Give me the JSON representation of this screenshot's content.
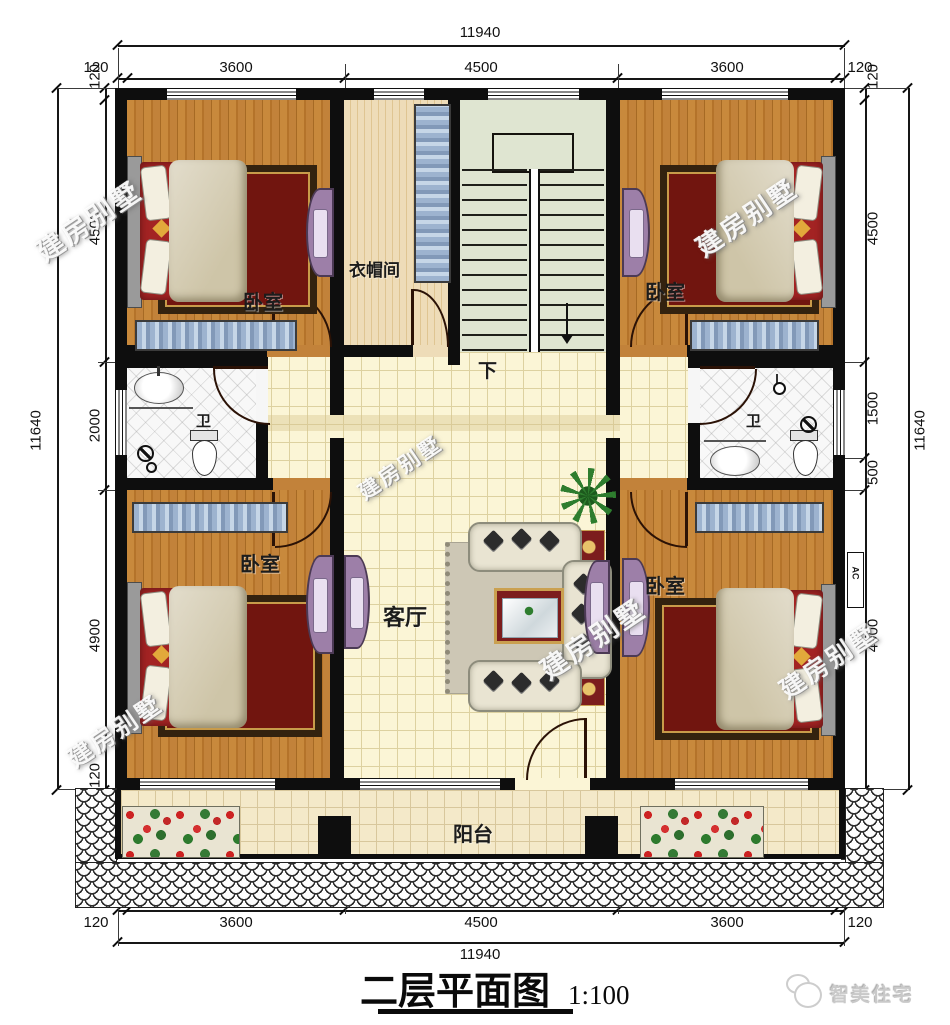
{
  "title": {
    "main": "二层平面图",
    "scale": "1:100"
  },
  "brand": {
    "name": "智美住宅"
  },
  "watermark": {
    "text": "建房别墅"
  },
  "rooms": {
    "bedroom_top_left": "卧室",
    "bedroom_top_right": "卧室",
    "bedroom_bottom_left": "卧室",
    "bedroom_bottom_right": "卧室",
    "cloakroom": "衣帽间",
    "bath_left": "卫",
    "bath_right": "卫",
    "living_room": "客厅",
    "balcony": "阳台",
    "stair_down": "下",
    "ac_unit": "AC"
  },
  "dimensions": {
    "top": {
      "total": "11940",
      "segments": [
        "120",
        "3600",
        "4500",
        "3600",
        "120"
      ]
    },
    "bottom": {
      "total": "11940",
      "segments": [
        "120",
        "3600",
        "4500",
        "3600",
        "120"
      ]
    },
    "left": {
      "total": "11640",
      "segments": [
        "120",
        "4500",
        "2000",
        "4900",
        "120",
        "1200"
      ]
    },
    "right": {
      "total": "11640",
      "segments": [
        "120",
        "4500",
        "1500",
        "500",
        "4900",
        "1200"
      ]
    }
  }
}
